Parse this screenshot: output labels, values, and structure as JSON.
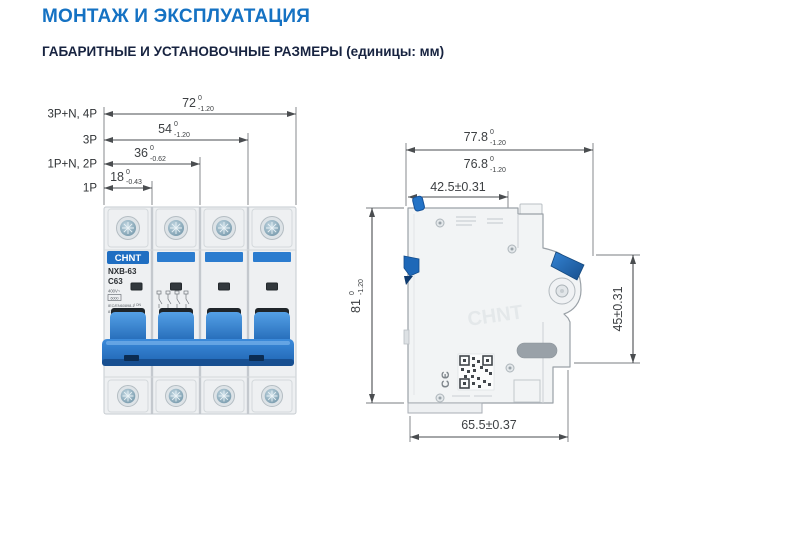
{
  "page": {
    "title": "МОНТАЖ И ЭКСПЛУАТАЦИЯ",
    "subtitle": "ГАБАРИТНЫЕ И УСТАНОВОЧНЫЕ РАЗМЕРЫ (единицы: мм)"
  },
  "front_view": {
    "poles": {
      "p4": "3P+N, 4P",
      "p3": "3P",
      "p2": "1P+N, 2P",
      "p1": "1P"
    },
    "dims": {
      "w72": {
        "v": "72",
        "hi": "0",
        "lo": "-1.20"
      },
      "w54": {
        "v": "54",
        "hi": "0",
        "lo": "-1.20"
      },
      "w36": {
        "v": "36",
        "hi": "0",
        "lo": "-0.62"
      },
      "w18": {
        "v": "18",
        "hi": "0",
        "lo": "-0.43"
      }
    },
    "breaker": {
      "brand": "CHNT",
      "model": "NXB-63",
      "rating": "C63",
      "voltage": "400V~",
      "capacity": "6000",
      "standard": "IEC/EN60898-1",
      "serial": "814254",
      "on_label": "I ON",
      "off_label": "O OFF"
    }
  },
  "side_view": {
    "dims": {
      "overall": {
        "v": "77.8",
        "hi": "0",
        "lo": "-1.20"
      },
      "body": {
        "v": "76.8",
        "hi": "0",
        "lo": "-1.20"
      },
      "top": "42.5±0.31",
      "height": {
        "v": "81",
        "hi": "0",
        "lo": "-1.20"
      },
      "right": "45±0.31",
      "bottom": "65.5±0.37"
    },
    "marks": {
      "ce": "CЄ"
    }
  },
  "colors": {
    "accent_blue": "#1572c3",
    "heading_navy": "#172340",
    "breaker_blue": "#2b7ccf",
    "drawing_line": "#4a4d50"
  }
}
